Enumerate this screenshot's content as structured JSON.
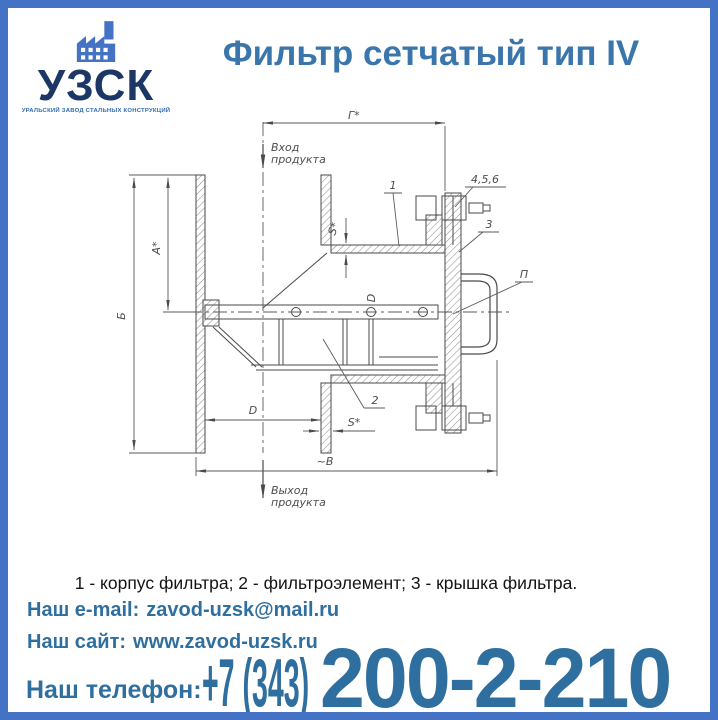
{
  "colors": {
    "frame_blue": "#4472c4",
    "logo_navy": "#1c3766",
    "logo_subtitle_blue": "#2e6cb5",
    "title_blue": "#3a76ac",
    "contact_steel_blue": "#2f6f9f",
    "drawing_line": "#4a4a4a"
  },
  "logo": {
    "abbr": "УЗСК",
    "subtitle": "УРАЛЬСКИЙ ЗАВОД СТАЛЬНЫХ КОНСТРУКЦИЙ",
    "icon": "factory-icon"
  },
  "title": "Фильтр сетчатый тип IV",
  "drawing": {
    "annotations": {
      "inlet_line1": "Вход",
      "inlet_line2": "продукта",
      "outlet_line1": "Выход",
      "outlet_line2": "продукта",
      "dim_g": "Г*",
      "dim_a": "А*",
      "dim_b": "Б",
      "dim_d_inner": "D",
      "dim_d_outlet": "D",
      "dim_s_wall": "S*",
      "dim_s_outlet": "S*",
      "dim_width": "~В",
      "part_body": "1",
      "part_element": "2",
      "part_cover": "3",
      "part_fasteners": "4,5,6",
      "part_handle": "П"
    }
  },
  "caption": "1 - корпус фильтра; 2 - фильтроэлемент; 3 - крышка фильтра.",
  "contacts": {
    "email_label": "Наш e-mail:",
    "email_value": "zavod-uzsk@mail.ru",
    "site_label": "Наш сайт:",
    "site_value": "www.zavod-uzsk.ru",
    "phone_label": "Наш телефон:",
    "phone_prefix": "+7 (343)",
    "phone_number": "200-2-210"
  }
}
